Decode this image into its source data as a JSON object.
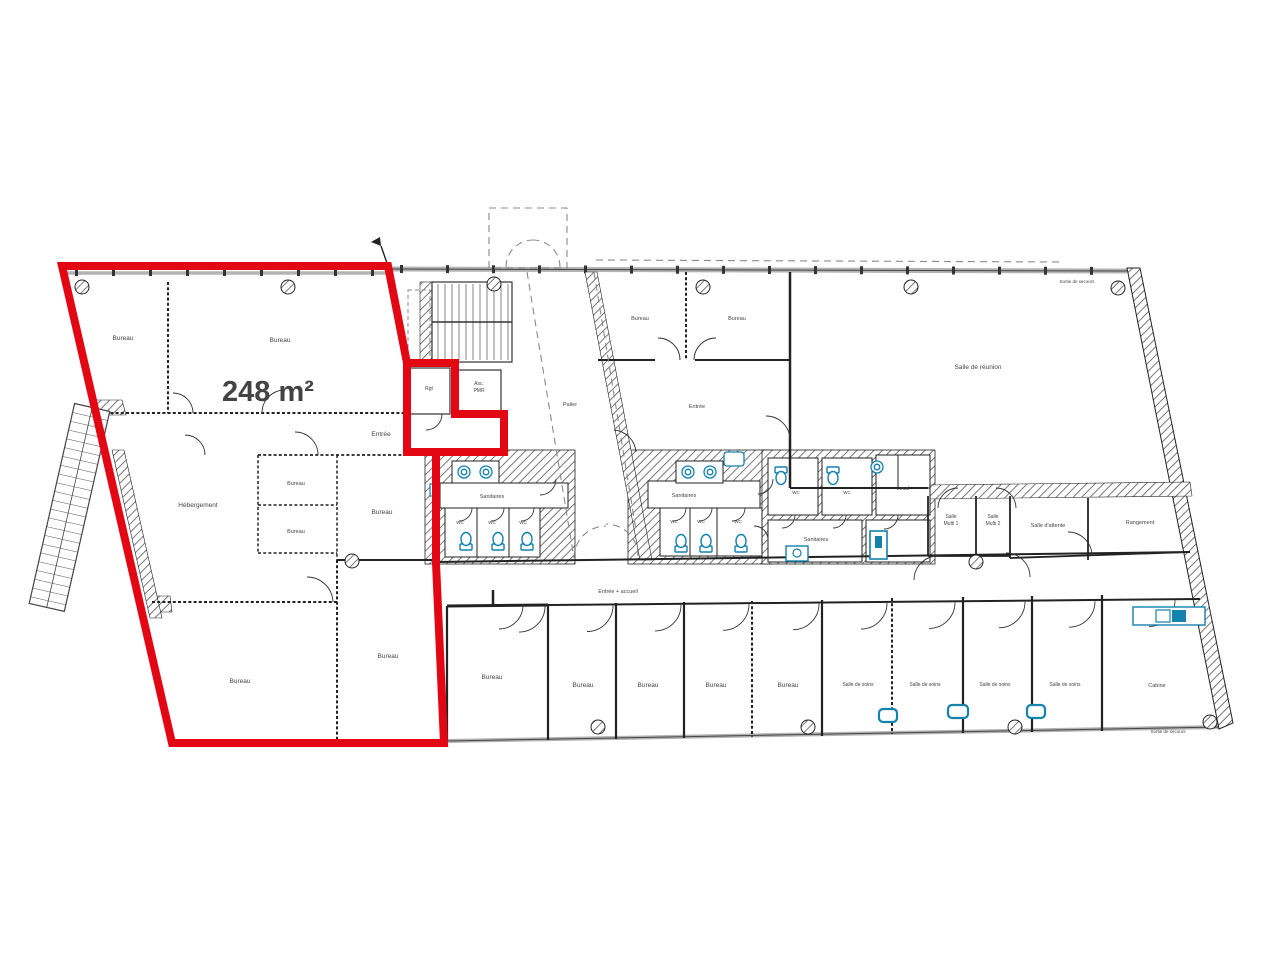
{
  "plan": {
    "highlight_area_label": "248 m²",
    "colors": {
      "highlight": "#e30613",
      "fixture": "#1581ad",
      "wall": "#222222",
      "label": "#444444"
    }
  },
  "labels": [
    {
      "name": "area-label",
      "text": "248 m²",
      "x": 268,
      "y": 401,
      "size": 29,
      "weight": "bold",
      "color": "#e30613"
    },
    {
      "name": "room-bureau-top-left",
      "text": "Bureau",
      "x": 123,
      "y": 340
    },
    {
      "name": "room-bureau-top-main",
      "text": "Bureau",
      "x": 280,
      "y": 342
    },
    {
      "name": "room-entree-zone",
      "text": "Entrée",
      "x": 381,
      "y": 436
    },
    {
      "name": "room-rgt",
      "text": "Rgt",
      "x": 429,
      "y": 390,
      "size": 5
    },
    {
      "name": "room-asc-line1",
      "text": "Asc.",
      "x": 479,
      "y": 385,
      "size": 5
    },
    {
      "name": "room-asc-line2",
      "text": "PMR",
      "x": 479,
      "y": 392,
      "size": 5
    },
    {
      "name": "room-hebergement",
      "text": "Hébergement",
      "x": 198,
      "y": 507
    },
    {
      "name": "room-bureau-small-1",
      "text": "Bureau",
      "x": 296,
      "y": 485,
      "size": 5.5
    },
    {
      "name": "room-bureau-small-2",
      "text": "Bureau",
      "x": 296,
      "y": 533,
      "size": 5.5
    },
    {
      "name": "room-bureau-mid",
      "text": "Bureau",
      "x": 382,
      "y": 514
    },
    {
      "name": "room-bureau-bottom-left",
      "text": "Bureau",
      "x": 240,
      "y": 683
    },
    {
      "name": "room-bureau-bottom-mid",
      "text": "Bureau",
      "x": 388,
      "y": 658
    },
    {
      "name": "room-palier",
      "text": "Palier",
      "x": 570,
      "y": 406,
      "size": 5.5
    },
    {
      "name": "room-bureau-t1",
      "text": "Bureau",
      "x": 640,
      "y": 320,
      "size": 5.5
    },
    {
      "name": "room-bureau-t2",
      "text": "Bureau",
      "x": 737,
      "y": 320,
      "size": 5.5
    },
    {
      "name": "room-entree-mid",
      "text": "Entrée",
      "x": 697,
      "y": 408,
      "size": 5.5
    },
    {
      "name": "room-salle-reunion",
      "text": "Salle de réunion",
      "x": 978,
      "y": 369
    },
    {
      "name": "room-sanitaires-left",
      "text": "Sanitaires",
      "x": 492,
      "y": 498,
      "size": 5.5
    },
    {
      "name": "room-wc-l1",
      "text": "WC",
      "x": 460,
      "y": 524,
      "size": 4.5
    },
    {
      "name": "room-wc-l2",
      "text": "WC",
      "x": 492,
      "y": 524,
      "size": 4.5
    },
    {
      "name": "room-wc-l3",
      "text": "WC",
      "x": 523,
      "y": 524,
      "size": 4.5
    },
    {
      "name": "room-sanitaires-mid",
      "text": "Sanitaires",
      "x": 684,
      "y": 497,
      "size": 5.5
    },
    {
      "name": "room-wc-m1",
      "text": "WC",
      "x": 674,
      "y": 523,
      "size": 4.5
    },
    {
      "name": "room-wc-m2",
      "text": "WC",
      "x": 701,
      "y": 523,
      "size": 4.5
    },
    {
      "name": "room-wc-m3",
      "text": "WC",
      "x": 738,
      "y": 523,
      "size": 4.5
    },
    {
      "name": "room-wc-r1",
      "text": "WC",
      "x": 796,
      "y": 494,
      "size": 4.5
    },
    {
      "name": "room-wc-r2",
      "text": "WC",
      "x": 847,
      "y": 494,
      "size": 4.5
    },
    {
      "name": "room-local",
      "text": "Local",
      "x": 903,
      "y": 490,
      "size": 5
    },
    {
      "name": "room-sanitaires-right",
      "text": "Sanitaires",
      "x": 816,
      "y": 541,
      "size": 5.5
    },
    {
      "name": "room-salle-multi-1a",
      "text": "Salle",
      "x": 951,
      "y": 518,
      "size": 5
    },
    {
      "name": "room-salle-multi-1b",
      "text": "Multi 1",
      "x": 951,
      "y": 525,
      "size": 5
    },
    {
      "name": "room-salle-multi-2a",
      "text": "Salle",
      "x": 993,
      "y": 518,
      "size": 5
    },
    {
      "name": "room-salle-multi-2b",
      "text": "Multi 2",
      "x": 993,
      "y": 525,
      "size": 5
    },
    {
      "name": "room-salle-attente",
      "text": "Salle d'attente",
      "x": 1048,
      "y": 527,
      "size": 5.5
    },
    {
      "name": "room-rangement",
      "text": "Rangement",
      "x": 1140,
      "y": 524,
      "size": 5.5
    },
    {
      "name": "corridor-label",
      "text": "Entrée + accueil",
      "x": 618,
      "y": 593,
      "size": 5.5
    },
    {
      "name": "room-bureau-b1",
      "text": "Bureau",
      "x": 492,
      "y": 679
    },
    {
      "name": "room-bureau-b2",
      "text": "Bureau",
      "x": 583,
      "y": 687
    },
    {
      "name": "room-bureau-b3",
      "text": "Bureau",
      "x": 648,
      "y": 687
    },
    {
      "name": "room-bureau-b4",
      "text": "Bureau",
      "x": 716,
      "y": 687
    },
    {
      "name": "room-bureau-b5",
      "text": "Bureau",
      "x": 788,
      "y": 687
    },
    {
      "name": "room-soins-1",
      "text": "Salle de soins",
      "x": 858,
      "y": 686,
      "size": 5
    },
    {
      "name": "room-soins-2",
      "text": "Salle de soins",
      "x": 925,
      "y": 686,
      "size": 5
    },
    {
      "name": "room-soins-3",
      "text": "Salle de soins",
      "x": 995,
      "y": 686,
      "size": 5
    },
    {
      "name": "room-soins-4",
      "text": "Salle de soins",
      "x": 1065,
      "y": 686,
      "size": 5
    },
    {
      "name": "room-cabine",
      "text": "Cabine",
      "x": 1157,
      "y": 687,
      "size": 5.5
    },
    {
      "name": "exit-top",
      "text": "Sortie de secours",
      "x": 1077,
      "y": 283,
      "size": 4.5
    },
    {
      "name": "exit-bottom",
      "text": "Sortie de secours",
      "x": 1168,
      "y": 733,
      "size": 4.5
    }
  ]
}
